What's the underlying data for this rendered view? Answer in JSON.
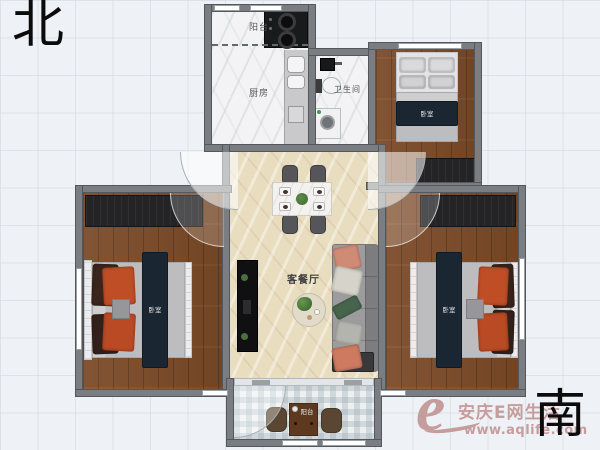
{
  "compass": {
    "north": "北",
    "south": "南"
  },
  "rooms": {
    "balcony_north": {
      "label": "阳台"
    },
    "kitchen": {
      "label": "厨房"
    },
    "bathroom": {
      "label": "卫生间"
    },
    "bedroom_northeast": {
      "label": "卧室"
    },
    "bedroom_west": {
      "label": "卧室"
    },
    "bedroom_southeast": {
      "label": "卧室"
    },
    "living_dining": {
      "label": "客餐厅"
    },
    "balcony_south": {
      "label": "阳台"
    }
  },
  "watermark": {
    "logo": "e",
    "site_name": "安庆E网生活",
    "site_url": "www.aqlife.com",
    "color": "#c69d9d"
  },
  "colors": {
    "background": "#eef1f5",
    "wall": "#7a7e83",
    "wood_floor": "#7b4a27",
    "living_floor": "#e9ddc0",
    "tile_floor": "#f3f3f5",
    "bed_runner_navy": "#1a2631",
    "pillow_orange": "#bf4e26",
    "sofa_gray": "#8e8e90",
    "wardrobe_dark": "#242427"
  }
}
